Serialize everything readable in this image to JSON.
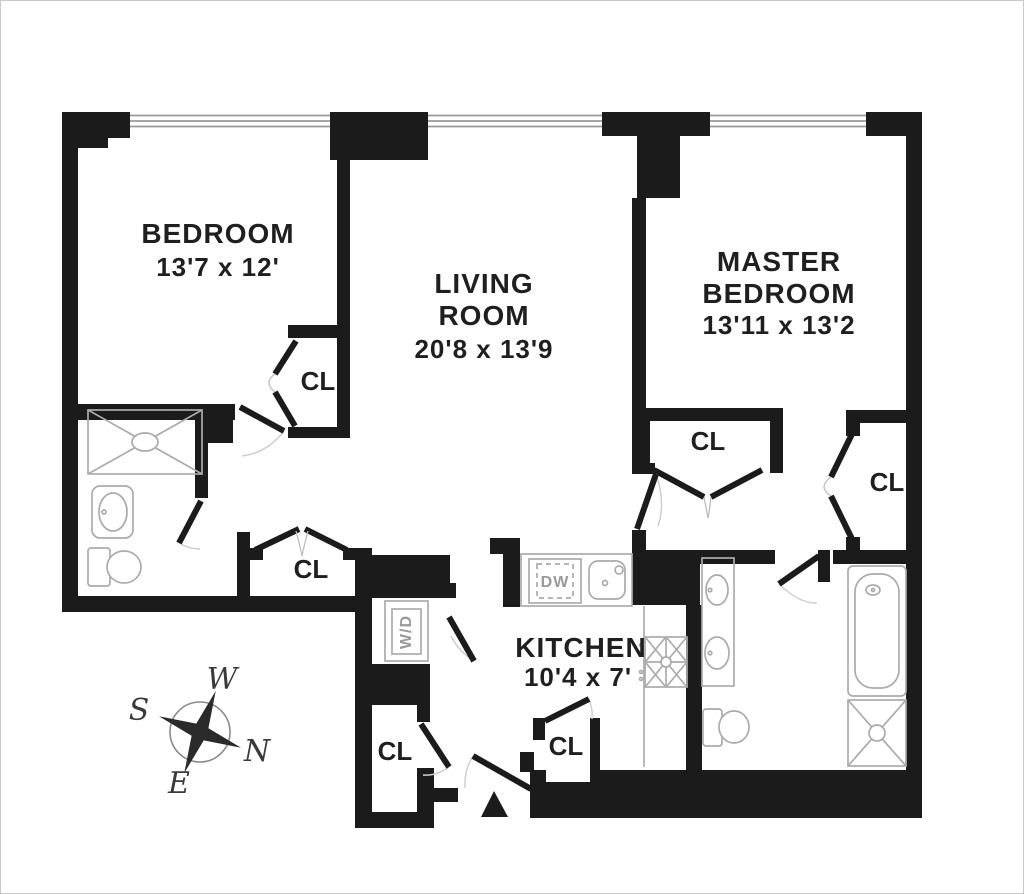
{
  "rooms": {
    "bedroom": {
      "name": "BEDROOM",
      "dims": "13'7 x 12'"
    },
    "living_room": {
      "name_line1": "LIVING",
      "name_line2": "ROOM",
      "dims": "20'8 x 13'9"
    },
    "master_bedroom": {
      "name_line1": "MASTER",
      "name_line2": "BEDROOM",
      "dims": "13'11 x 13'2"
    },
    "kitchen": {
      "name": "KITCHEN",
      "dims": "10'4 x 7'"
    }
  },
  "labels": {
    "closet": "CL",
    "dishwasher": "DW",
    "washer_dryer": "W/D"
  },
  "compass": {
    "north": "N",
    "south": "S",
    "east": "E",
    "west": "W"
  },
  "colors": {
    "walls": "#1b1b1b",
    "fixtures": "#ababab",
    "text": "#1f1f1f",
    "fixture_text": "#9a9a9a",
    "window": "#999999",
    "border": "#c9c9c9",
    "background": "#ffffff"
  }
}
